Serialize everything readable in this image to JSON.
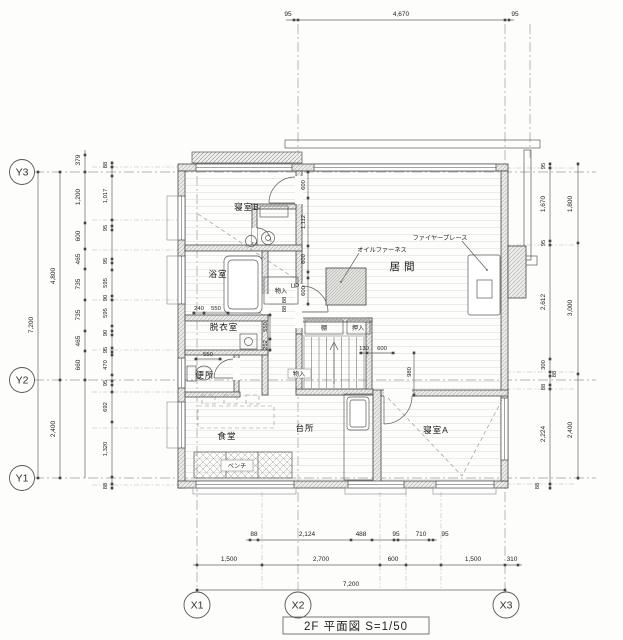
{
  "title": {
    "label": "2F 平面図  S=1/50"
  },
  "grid": {
    "y_axes": [
      "Y3",
      "Y2",
      "Y1"
    ],
    "x_axes": [
      "X1",
      "X2",
      "X3"
    ]
  },
  "rooms": {
    "bedroom_b": "寝室B",
    "bath": "浴室",
    "dressing": "脱衣室",
    "toilet": "便所",
    "living": "居間",
    "dining": "食堂",
    "kitchen": "台所",
    "bedroom_a": "寝室A"
  },
  "annotations": {
    "oil_furnace": "オイルファーネス",
    "fireplace": "ファイヤープレース",
    "bench": "ベンチ",
    "storage_a": "物入",
    "storage_b": "物入",
    "shelf": "棚",
    "closet": "押入",
    "up": "UP"
  },
  "dimensions": {
    "top": [
      "95",
      "4,670",
      "95"
    ],
    "left_total": "7,200",
    "left_spans": [
      "4,800",
      "2,400"
    ],
    "left_outer": [
      "379",
      "1,200",
      "600",
      "465",
      "735",
      "735",
      "465",
      "660"
    ],
    "left_inner": [
      "88",
      "1,017",
      "95",
      "95",
      "595",
      "90",
      "595",
      "90",
      "95",
      "470",
      "95",
      "692",
      "1,320",
      "88"
    ],
    "right_inner": [
      "95",
      "1,670",
      "95",
      "2,612",
      "300",
      "88",
      "88",
      "2,224",
      "88"
    ],
    "right_outer": [
      "1,800",
      "3,000",
      "2,400"
    ],
    "bottom_upper": [
      "88",
      "2,124",
      "488",
      "95",
      "710",
      "95"
    ],
    "bottom_mid": [
      "1,500",
      "2,700",
      "600",
      "1,500",
      "310"
    ],
    "bottom_total": "7,200",
    "interior": [
      "600",
      "1,112",
      "600",
      "240",
      "550",
      "550",
      "252",
      "550",
      "130",
      "600",
      "980",
      "600",
      "88",
      "88"
    ]
  }
}
